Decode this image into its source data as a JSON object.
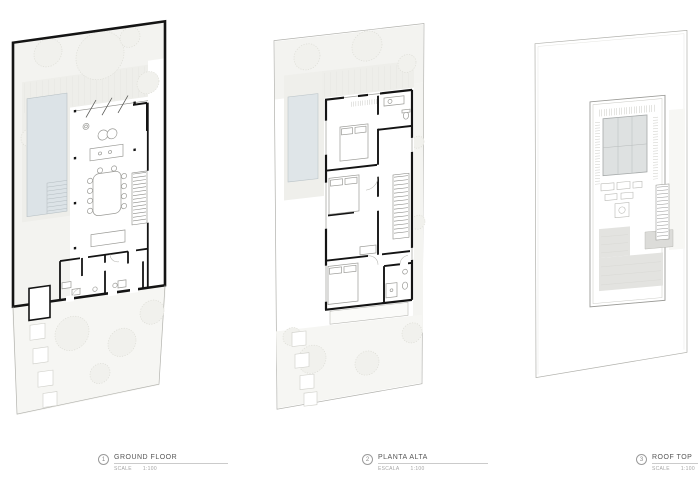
{
  "sheet": {
    "background": "#ffffff"
  },
  "plans": [
    {
      "number": "1",
      "title": "GROUND FLOOR",
      "scale_label": "SCALE",
      "scale_value": "1:100"
    },
    {
      "number": "2",
      "title": "PLANTA ALTA",
      "scale_label": "ESCALA",
      "scale_value": "1:100"
    },
    {
      "number": "3",
      "title": "ROOF TOP",
      "scale_label": "SCALE",
      "scale_value": "1:100"
    }
  ],
  "colors": {
    "wall": "#141414",
    "pool": "#dce3e7",
    "garden": "#f3f3f0",
    "deck": "#eeeeea",
    "roof_gray": "#e3e3e0",
    "solar_panel_gray": "#dee1e1",
    "thin_line": "#9a9a96",
    "label_text": "#565656",
    "label_muted": "#a5a5a5"
  }
}
